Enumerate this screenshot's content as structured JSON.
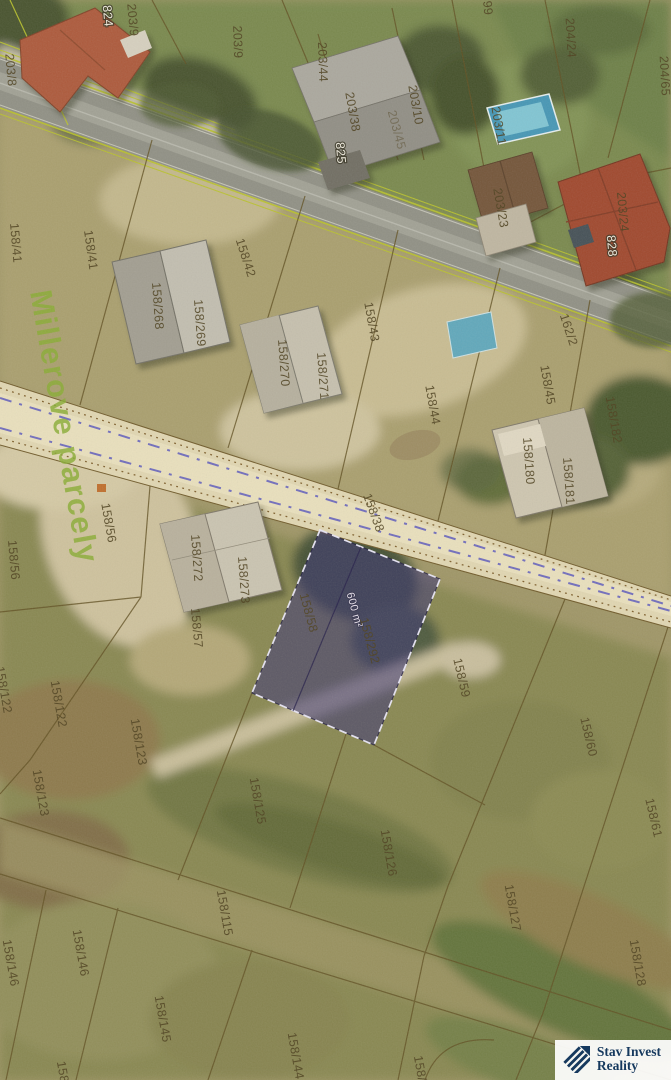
{
  "map": {
    "watermark": {
      "text": "Millerove parcely",
      "color": "#85ad2f"
    },
    "highlight_parcel": {
      "fill_rgba": "rgba(48,42,116,0.55)",
      "area_label": "600 m²",
      "parcel_numbers": [
        "158/58",
        "158/292"
      ]
    },
    "colors": {
      "road_border": "#b9c427",
      "street_marking": "#5654c2",
      "boundary": "#5b4a1d"
    },
    "labels": [
      {
        "text": "824",
        "x": 107,
        "y": 16,
        "r": 85,
        "style": "building"
      },
      {
        "text": "203/9",
        "x": 132,
        "y": 20,
        "r": 85
      },
      {
        "text": "203/8",
        "x": 10,
        "y": 70,
        "r": 85
      },
      {
        "text": "203/9",
        "x": 237,
        "y": 42,
        "r": 88
      },
      {
        "text": "203/44",
        "x": 322,
        "y": 62,
        "r": 88
      },
      {
        "text": "203/38",
        "x": 352,
        "y": 112,
        "r": 80
      },
      {
        "text": "203/45",
        "x": 396,
        "y": 130,
        "r": 75,
        "style": "faint"
      },
      {
        "text": "825",
        "x": 340,
        "y": 153,
        "r": 85,
        "style": "building"
      },
      {
        "text": "203/10",
        "x": 415,
        "y": 105,
        "r": 80
      },
      {
        "text": "99",
        "x": 487,
        "y": 8,
        "r": 85
      },
      {
        "text": "203/11",
        "x": 498,
        "y": 126,
        "r": 80
      },
      {
        "text": "203/23",
        "x": 500,
        "y": 208,
        "r": 80
      },
      {
        "text": "204/24",
        "x": 570,
        "y": 38,
        "r": 87
      },
      {
        "text": "204/65",
        "x": 664,
        "y": 76,
        "r": 87
      },
      {
        "text": "203/24",
        "x": 622,
        "y": 212,
        "r": 85
      },
      {
        "text": "828",
        "x": 611,
        "y": 246,
        "r": 85,
        "style": "building"
      },
      {
        "text": "162/2",
        "x": 568,
        "y": 330,
        "r": 72
      },
      {
        "text": "158/41",
        "x": 15,
        "y": 243,
        "r": 85
      },
      {
        "text": "158/41",
        "x": 90,
        "y": 250,
        "r": 82
      },
      {
        "text": "158/42",
        "x": 245,
        "y": 258,
        "r": 72
      },
      {
        "text": "158/43",
        "x": 371,
        "y": 322,
        "r": 80
      },
      {
        "text": "158/268",
        "x": 157,
        "y": 306,
        "r": 86
      },
      {
        "text": "158/269",
        "x": 199,
        "y": 323,
        "r": 86
      },
      {
        "text": "158/270",
        "x": 283,
        "y": 363,
        "r": 86
      },
      {
        "text": "158/271",
        "x": 322,
        "y": 376,
        "r": 86
      },
      {
        "text": "158/44",
        "x": 432,
        "y": 405,
        "r": 80
      },
      {
        "text": "158/45",
        "x": 547,
        "y": 385,
        "r": 80
      },
      {
        "text": "158/180",
        "x": 528,
        "y": 461,
        "r": 86
      },
      {
        "text": "158/181",
        "x": 568,
        "y": 481,
        "r": 86
      },
      {
        "text": "158/182",
        "x": 613,
        "y": 420,
        "r": 80
      },
      {
        "text": "158/38",
        "x": 373,
        "y": 513,
        "r": 70
      },
      {
        "text": "158/56",
        "x": 13,
        "y": 560,
        "r": 85
      },
      {
        "text": "158/56",
        "x": 108,
        "y": 523,
        "r": 80
      },
      {
        "text": "158/272",
        "x": 196,
        "y": 558,
        "r": 86
      },
      {
        "text": "158/273",
        "x": 243,
        "y": 580,
        "r": 86
      },
      {
        "text": "158/57",
        "x": 196,
        "y": 628,
        "r": 85
      },
      {
        "text": "158/58",
        "x": 308,
        "y": 613,
        "r": 75
      },
      {
        "text": "600 m²",
        "x": 354,
        "y": 610,
        "r": 75,
        "style": "area"
      },
      {
        "text": "158/292",
        "x": 369,
        "y": 641,
        "r": 75
      },
      {
        "text": "158/59",
        "x": 461,
        "y": 678,
        "r": 77
      },
      {
        "text": "158/60",
        "x": 588,
        "y": 737,
        "r": 77
      },
      {
        "text": "158/61",
        "x": 653,
        "y": 818,
        "r": 77
      },
      {
        "text": "158/122",
        "x": 58,
        "y": 704,
        "r": 80
      },
      {
        "text": "158/122",
        "x": 3,
        "y": 690,
        "r": 80
      },
      {
        "text": "158/123",
        "x": 40,
        "y": 793,
        "r": 80
      },
      {
        "text": "158/123",
        "x": 138,
        "y": 742,
        "r": 80
      },
      {
        "text": "158/125",
        "x": 257,
        "y": 801,
        "r": 80
      },
      {
        "text": "158/126",
        "x": 388,
        "y": 853,
        "r": 80
      },
      {
        "text": "158/115",
        "x": 224,
        "y": 913,
        "r": 80
      },
      {
        "text": "158/127",
        "x": 512,
        "y": 908,
        "r": 80
      },
      {
        "text": "158/128",
        "x": 637,
        "y": 963,
        "r": 80
      },
      {
        "text": "158/146",
        "x": 10,
        "y": 963,
        "r": 80
      },
      {
        "text": "158/146",
        "x": 80,
        "y": 953,
        "r": 80
      },
      {
        "text": "158/145",
        "x": 162,
        "y": 1019,
        "r": 80
      },
      {
        "text": "158/144",
        "x": 295,
        "y": 1056,
        "r": 80
      },
      {
        "text": "158/1",
        "x": 420,
        "y": 1072,
        "r": 80
      },
      {
        "text": "158",
        "x": 62,
        "y": 1072,
        "r": 80
      }
    ]
  },
  "logo": {
    "line1": "Stav Invest",
    "line2": "Reality",
    "color": "#16395e"
  }
}
